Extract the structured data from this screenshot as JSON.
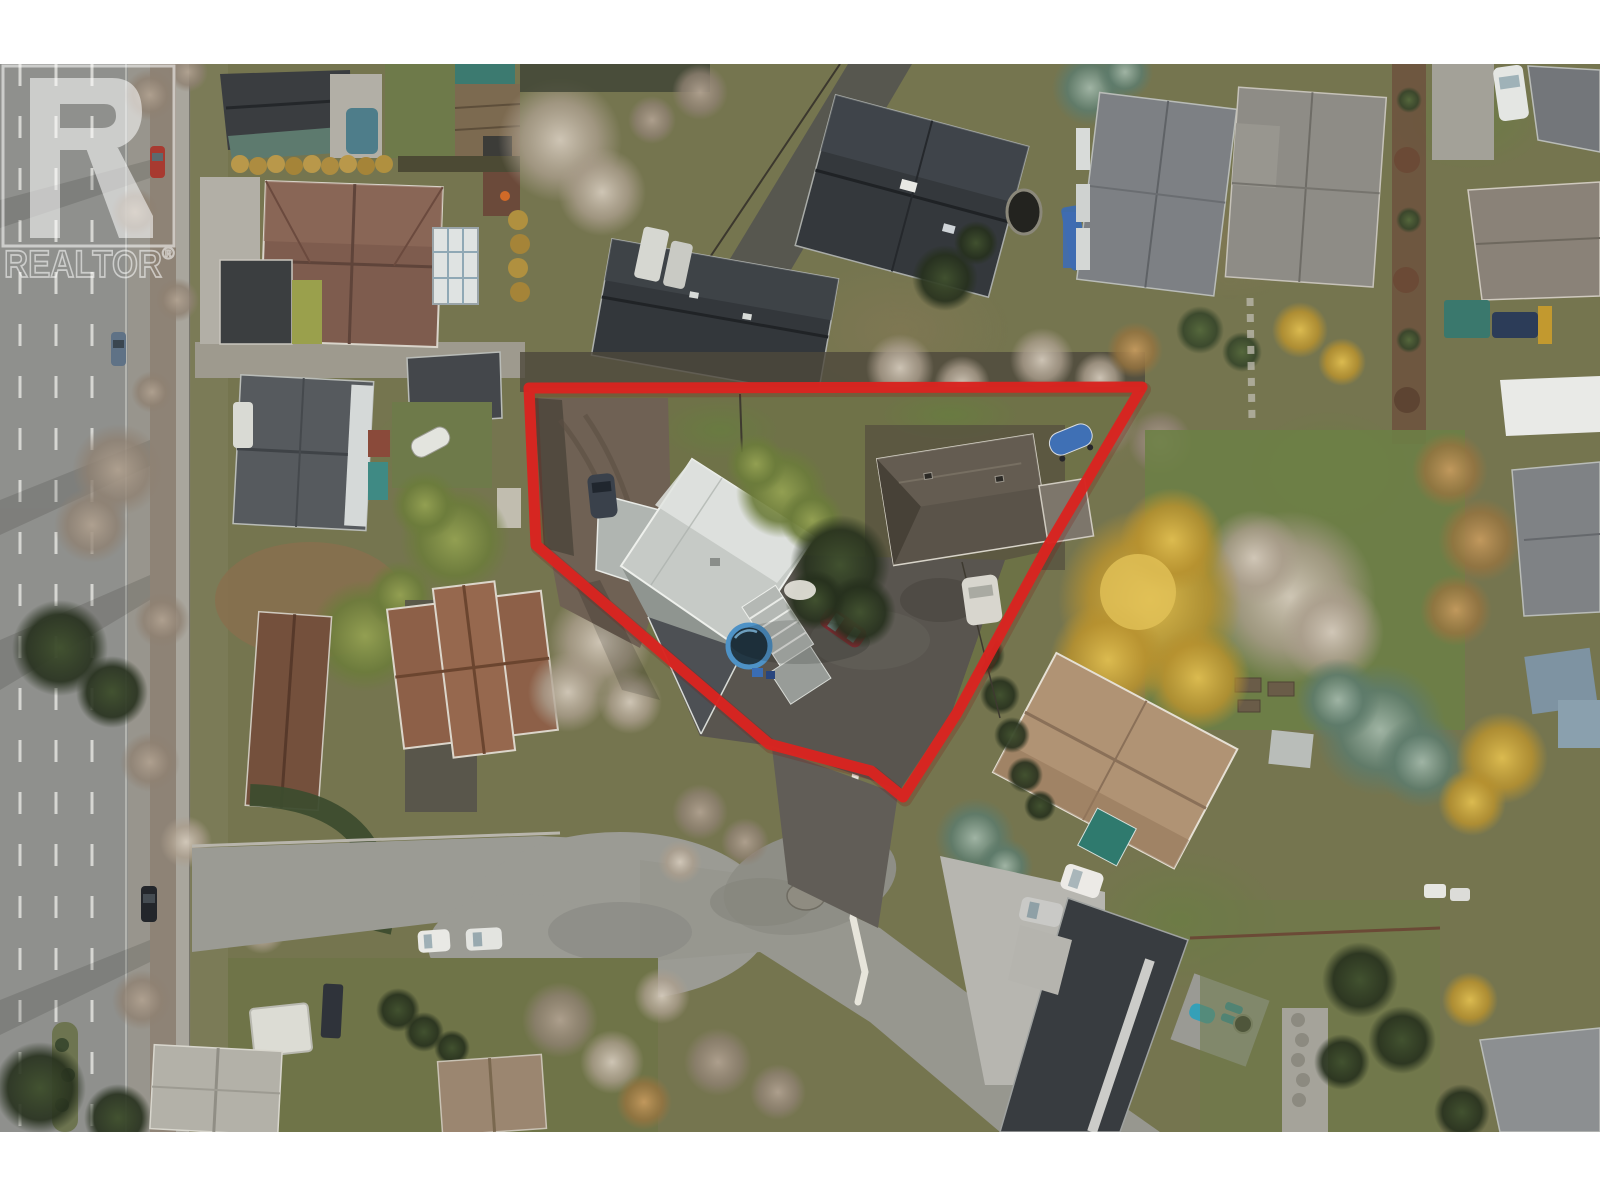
{
  "meta": {
    "kind": "aerial-drone-real-estate-photo",
    "width": 1600,
    "height": 1200,
    "letterbox_color": "#ffffff",
    "photo_top": 64,
    "photo_bottom": 1132
  },
  "watermark": {
    "brand": "REALTOR",
    "registered_symbol": "®",
    "color": "#ffffff",
    "opacity": 0.55
  },
  "lot_boundary": {
    "color": "#d92420",
    "shadow_color": "#7e120f",
    "stroke_width": 11,
    "points": "529,388 1142,387 1047,548 957,713 903,797 871,771 769,744 536,545"
  },
  "scene": {
    "description": "Top-down winter aerial of a residential neighbourhood; a red outline marks an irregular corner lot containing a light-grey-roof house, a dark-roof secondary building, a round pool, parked cars and a large asphalt driveway. A multi-lane highway with treed boulevard runs along the left edge; a cul-de-sac street sits below the lot.",
    "notable_objects": [
      "highway",
      "boulevard-trees",
      "brown-roof-house-nw",
      "grey-house-with-white-ridge",
      "terracotta-house-sw",
      "dark-roof-houses-north",
      "subject-main-house",
      "subject-second-house",
      "round-pool",
      "red-car",
      "dark-car",
      "white-car",
      "blue-boat",
      "golden-willow-tree",
      "cul-de-sac",
      "modern-dark-roof-house-se",
      "tan-roof-house-se",
      "realtor-watermark",
      "red-lot-outline"
    ]
  },
  "palette": {
    "road_grey": "#8f908d",
    "street_grey": "#9b9b94",
    "asphalt_dark": "#59554f",
    "lawn_olive": "#75754f",
    "lawn_green": "#6d8046",
    "roof_light": "#c6cac6",
    "roof_dark": "#33373b",
    "roof_brown": "#7e5c4e",
    "roof_terracotta": "#8d6048",
    "pool_ring": "#4e92c6",
    "golden_tree": "#c9a23c",
    "conifer": "#3f4f30",
    "bare_tree": "#a39382"
  }
}
